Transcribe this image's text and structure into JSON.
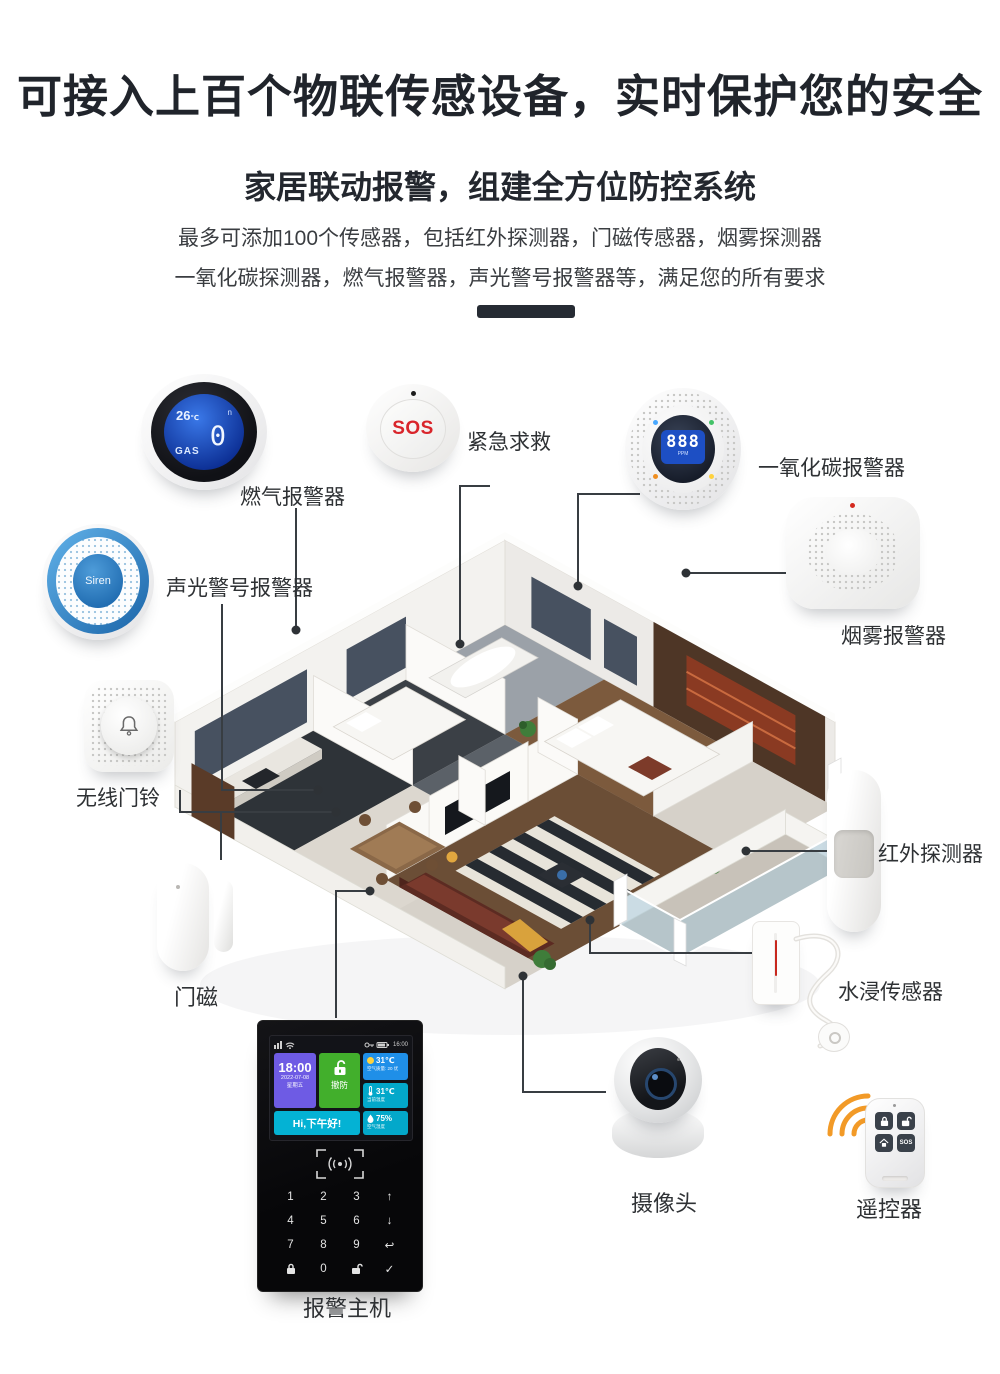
{
  "header": {
    "title": "可接入上百个物联传感设备，实时保护您的安全",
    "subtitle": "家居联动报警，组建全方位防控系统",
    "desc_lines": [
      "最多可添加100个传感器，包括红外探测器，门磁传感器，烟雾探测器",
      "一氧化碳探测器，燃气报警器，声光警号报警器等，满足您的所有要求"
    ]
  },
  "devices": {
    "gas_alarm": {
      "label": "燃气报警器",
      "screen": {
        "temp": "26",
        "temp_unit": "℃",
        "value": "0",
        "gas_label": "GAS",
        "mode": "n"
      }
    },
    "sos_button": {
      "label": "紧急求救",
      "button_text": "SOS"
    },
    "co_alarm": {
      "label": "一氧化碳报警器",
      "screen": {
        "value": "888",
        "unit": "PPM"
      }
    },
    "smoke_alarm": {
      "label": "烟雾报警器"
    },
    "siren": {
      "label": "声光警号报警器",
      "device_text": "Siren"
    },
    "doorbell": {
      "label": "无线门铃"
    },
    "pir_detector": {
      "label": "红外探测器"
    },
    "door_sensor": {
      "label": "门磁"
    },
    "water_sensor": {
      "label": "水浸传感器"
    },
    "camera": {
      "label": "摄像头"
    },
    "remote": {
      "label": "遥控器",
      "sos_button": "SOS"
    },
    "alarm_host": {
      "label": "报警主机",
      "statusbar": {
        "time": "16:00"
      },
      "screen": {
        "time": "18:00",
        "date": "2022-07-08",
        "weekday": "星期五",
        "mode": "撤防",
        "weather_temp": "31℃",
        "weather_sub": "空气质量: 20 优",
        "indoor_temp": "31℃",
        "indoor_sub": "当前温度",
        "greeting": "Hi,下午好!",
        "humidity": "75%",
        "humidity_sub": "空气湿度"
      },
      "keypad": {
        "rows": [
          [
            "1",
            "2",
            "3",
            "up"
          ],
          [
            "4",
            "5",
            "6",
            "down"
          ],
          [
            "7",
            "8",
            "9",
            "back"
          ],
          [
            "lock",
            "0",
            "unlock",
            "ok"
          ]
        ]
      }
    }
  },
  "colors": {
    "title_text": "#20242b",
    "accent_blue": "#1f8fe8",
    "lcd_blue": "#1d4fc4",
    "alert_red": "#d9252b",
    "arc_orange": "#f29a27",
    "connector_line": "#383d42"
  }
}
